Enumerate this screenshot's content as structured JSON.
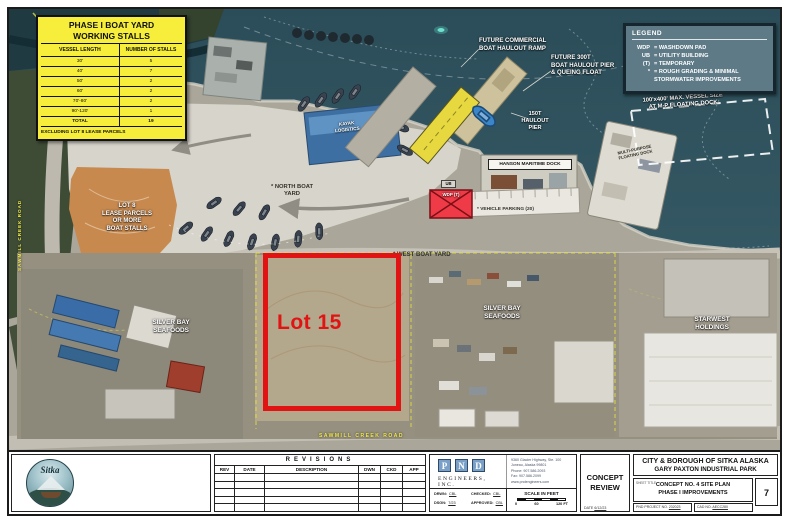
{
  "colors": {
    "red": "#e11313",
    "annotYellow": "#f3ea45",
    "tableYellow": "#f6ee3b",
    "water": "#2e505c",
    "legendBg": "#5e7a86"
  },
  "stall_table": {
    "title": "PHASE I BOAT YARD\nWORKING STALLS",
    "col1": "VESSEL LENGTH",
    "col2": "NUMBER OF STALLS",
    "rows": [
      [
        "30'",
        "5"
      ],
      [
        "40'",
        "7"
      ],
      [
        "50'",
        "2"
      ],
      [
        "60'",
        "2"
      ],
      [
        "70'-80'",
        "2"
      ],
      [
        "90'-120'",
        "1"
      ]
    ],
    "total_label": "TOTAL",
    "total_value": "19",
    "footnote": "EXCLUDING LOT 8 LEASE PARCELS"
  },
  "legend": {
    "title": "LEGEND",
    "items": [
      {
        "key": "WDP",
        "desc": "= WASHDOWN PAD"
      },
      {
        "key": "UB",
        "desc": "= UTILITY BUILDING"
      },
      {
        "key": "(T)",
        "desc": "= TEMPORARY"
      },
      {
        "key": "*",
        "desc": "= ROUGH GRADING & MINIMAL\nSTORMWATER IMPROVEMENTS"
      }
    ]
  },
  "map": {
    "creek": "SAWMILL CREEK",
    "road_left": "SAWMILL CREEK ROAD",
    "road_bottom": "SAWMILL CREEK ROAD",
    "future_ramp": "FUTURE COMMERCIAL\nBOAT HAULOUT RAMP",
    "future_pier": "FUTURE 300T\nBOAT HAULOUT PIER\n& QUEING FLOAT",
    "haulout_150t": "150T\nHAULOUT\nPIER",
    "vessel_size": "100'x400' MAX. VESSEL SIZE\nAT M-P FLOATING DOCK",
    "mp_dock": "MULTI-PURPOSE\nFLOATING DOCK",
    "hanson": "HANSON MARITIME DOCK",
    "parking": "* VEHICLE PARKING (20)",
    "wdp": "WDP (T)",
    "ub": "UB",
    "north_yard": "* NORTH BOAT\nYARD",
    "west_yard": "* WEST BOAT YARD",
    "lot8": "LOT 8\nLEASE PARCELS\nOR MORE\nBOAT STALLS",
    "lot15": "Lot 15",
    "sbs_left": "SILVER BAY\nSEAFOODS",
    "sbs_center": "SILVER BAY\nSEAFOODS",
    "starwest": "STARWEST\nHOLDINGS",
    "logistics": "KAYAK\nLOGISTICS"
  },
  "title_block": {
    "logo_text": "Sitka",
    "revisions": {
      "title": "REVISIONS",
      "cols": [
        "REV",
        "DATE",
        "DESCRIPTION",
        "DWN",
        "CKD",
        "APP"
      ]
    },
    "pnd": {
      "letters": [
        "P",
        "N",
        "D"
      ],
      "name": "ENGINEERS, INC.",
      "address": "9360 Glacier Highway, Ste. 100\nJuneau, Alaska 99801\nPhone: 907.586.2093\nFax: 907.586.2099\nwww.pndengineers.com",
      "fields": [
        {
          "label": "DRWN:",
          "value": "CBL"
        },
        {
          "label": "CHECKED:",
          "value": "CBL"
        },
        {
          "label": "DSGN:",
          "value": "7/23"
        },
        {
          "label": "APPROVED:",
          "value": "CBL"
        }
      ],
      "scale_title": "SCALE IN FEET",
      "scale_ticks": [
        "0",
        "60",
        "120 FT"
      ]
    },
    "concept": {
      "text": "CONCEPT\nREVIEW",
      "date_label": "DATE",
      "date": "6/12/23"
    },
    "agency": "CITY & BOROUGH OF SITKA ALASKA",
    "park": "GARY PAXTON INDUSTRIAL PARK",
    "sheet_title_label": "SHEET TITLE",
    "sheet_title": "CONCEPT NO. 4 SITE PLAN\nPHASE I IMPROVEMENTS",
    "project_label": "PND PROJECT NO.",
    "project_no": "232023",
    "cad_label": "CAD NO.",
    "cad_no": "AECC280",
    "sheet_no": "7"
  }
}
